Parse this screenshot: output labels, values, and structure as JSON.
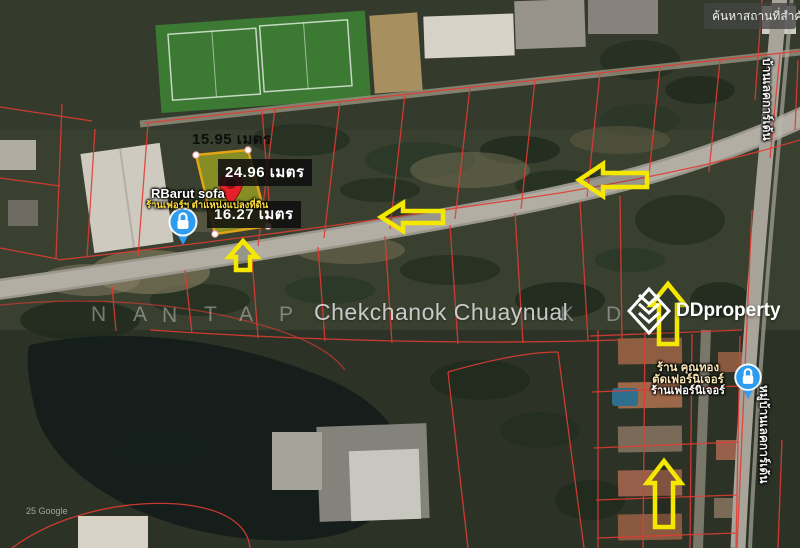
{
  "search_box": {
    "label": "ค้นหาสถานที่สำคัญ"
  },
  "measurements": {
    "top_width": "15.95 เมตร",
    "side_length": "24.96 เมตร",
    "bottom_width": "16.27 เมตร"
  },
  "poi_shop_main": {
    "name": "RBarut sofa",
    "caption": "ร้านเฟอร์ฯ ตำแหน่งแปลงที่ดิน"
  },
  "poi_shop_right": {
    "line1": "ร้าน คุณทอง",
    "line2": "ตัดเฟอร์นิเจอร์",
    "line3": "ร้านเฟอร์นิเจอร์"
  },
  "streets": {
    "right_top": "บ้านเลคการ์เด้น",
    "right_bottom": "หมู่บ้านเลคการ์เด้น"
  },
  "watermark": {
    "letters_before": [
      "N",
      "A",
      "N",
      "T",
      "A",
      "P"
    ],
    "name": "Chekchanok Chuaynual",
    "letters_after": [
      "K",
      "D"
    ]
  },
  "brand": {
    "logo_text": "DDproperty"
  },
  "credit": "25 Google",
  "icons": {
    "poi_icon": "lock-place-icon",
    "pin": "map-pin-icon",
    "logo": "ddproperty-diamond-icon"
  },
  "colors": {
    "arrow_yellow": "#f4e800",
    "parcel_red": "#e23b33",
    "plot_fill": "#c8cc1e",
    "plot_border": "#e2a416",
    "pin_red": "#e5202a",
    "poi_blue": "#2e9df0"
  }
}
